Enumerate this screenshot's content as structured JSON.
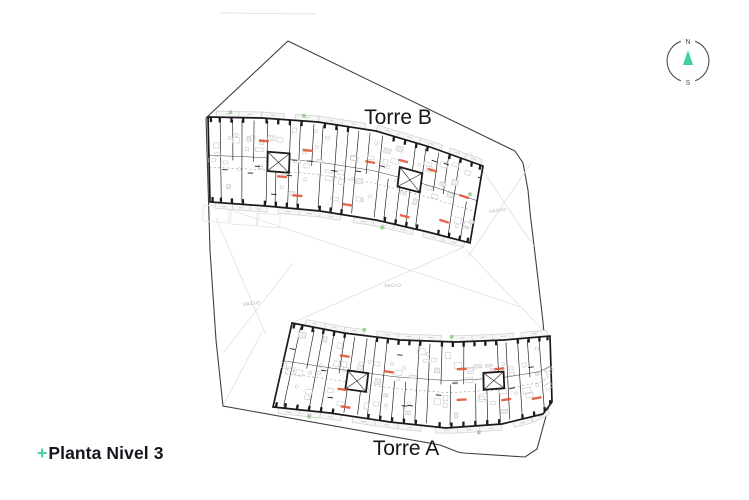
{
  "plan": {
    "tower_b_label": "Torre B",
    "tower_a_label": "Torre A",
    "void_labels": {
      "left": "VACIO",
      "center": "VACIO",
      "right": "VACIO"
    }
  },
  "compass": {
    "north_label": "N",
    "south_label": "S"
  },
  "footer": {
    "plus_mark": "+",
    "title": "Planta Nivel 3"
  },
  "colors": {
    "accent_teal": "#3ecfa6",
    "unit_label_red": "#e0573a",
    "boundary_line": "#3f3f3f",
    "wall_ink": "#1b1b1b",
    "furniture_gray": "#c4c4c4",
    "balcony_gray": "#cfcfcf",
    "faint_line": "#e3e3e3",
    "plant_green": "#8bc97f"
  }
}
